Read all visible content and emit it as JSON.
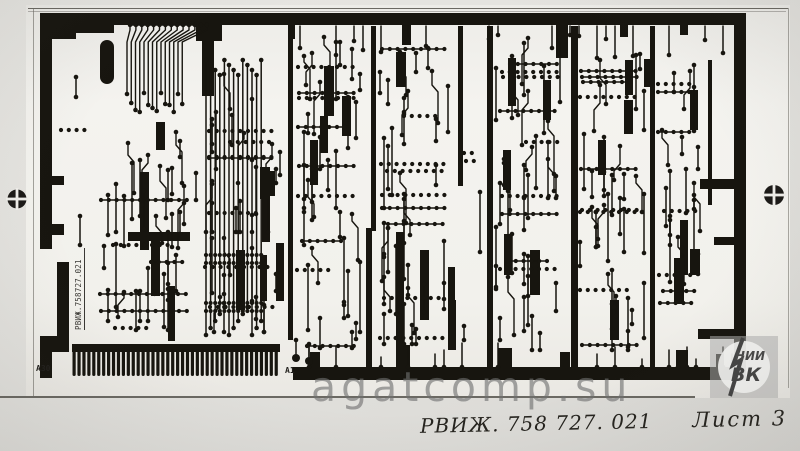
{
  "photo": {
    "description": "Photograph of a printed circuit board photomask artwork drawing"
  },
  "board": {
    "doc_number_vertical": "РВИЖ.758727.021",
    "connector_start_label": "А30",
    "connector_end_label": "А1"
  },
  "caption": {
    "doc_number": "РВИЖ. 758 727. 021",
    "sheet_label": "Лист 3"
  },
  "watermarks": {
    "site": "agatcomp.su",
    "logo_top": "НИИ",
    "logo_bottom": "ВК"
  },
  "colors": {
    "trace_black": "#17150f",
    "paper": "#f3f2ee",
    "photo_margin": "#d9d8d4",
    "watermark_gray": "#8c8c8c"
  }
}
